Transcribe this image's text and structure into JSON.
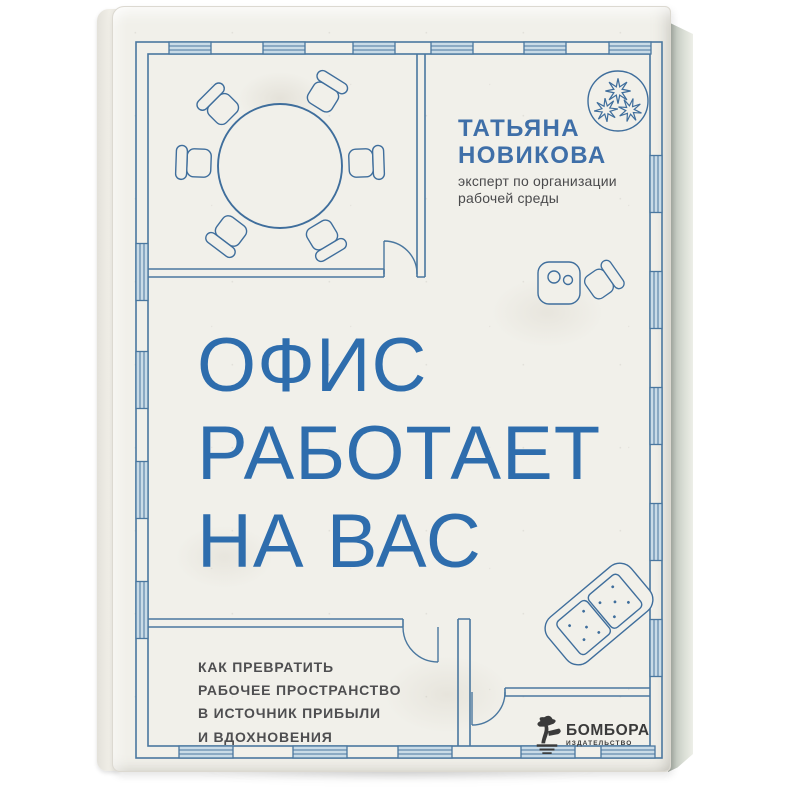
{
  "book": {
    "author": {
      "name_lines": [
        "ТАТЬЯНА",
        "НОВИКОВА"
      ],
      "role_lines": [
        "эксперт по организации",
        "рабочей среды"
      ]
    },
    "title_lines": [
      "ОФИС",
      "РАБОТАЕТ",
      "НА ВАС"
    ],
    "subtitle_lines": [
      "КАК ПРЕВРАТИТЬ",
      "РАБОЧЕЕ ПРОСТРАНСТВО",
      "В ИСТОЧНИК ПРИБЫЛИ",
      "И ВДОХНОВЕНИЯ"
    ],
    "publisher": {
      "name": "БОМБОРА",
      "type": "ИЗДАТЕЛЬСТВО"
    },
    "colors": {
      "title_blue": "#2e6dad",
      "plan_line_blue": "#4a779f",
      "window_fill": "#c9dbe7",
      "subtitle_gray": "#4e4e50",
      "logo_dark": "#3a3a3a",
      "cover_paper": "#f1f0ea"
    },
    "icons": {
      "plant": "plant-top-view-icon",
      "meeting_table": "round-table-icon",
      "chair": "chair-icon",
      "workstation": "workstation-desk-icon",
      "sofa": "sofa-icon",
      "publisher_logo": "bonsai-tree-logo-icon"
    }
  }
}
